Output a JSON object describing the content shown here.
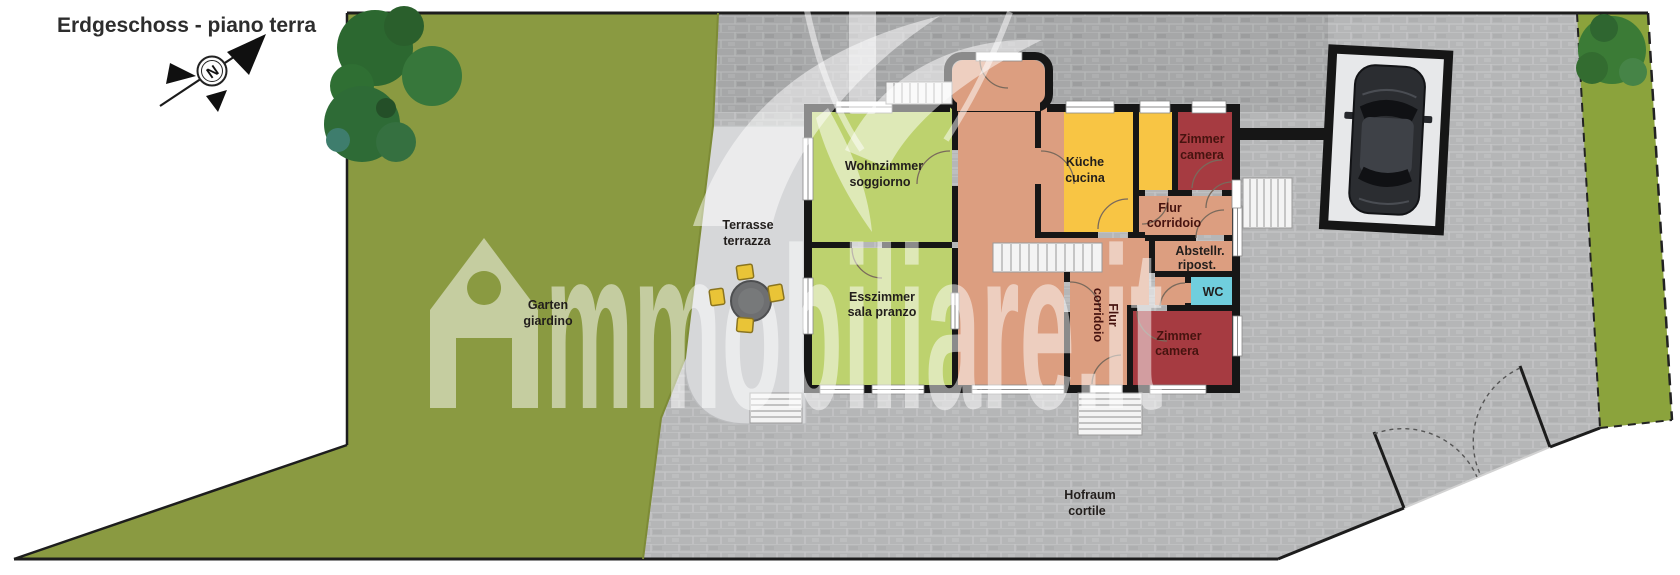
{
  "title": "Erdgeschoss - piano terra",
  "compass": {
    "north_label": "N"
  },
  "watermark": {
    "brand": "mmobiliare.it"
  },
  "labels": {
    "wohnzimmer": {
      "line1": "Wohnzimmer",
      "line2": "soggiorno"
    },
    "esszimmer": {
      "line1": "Esszimmer",
      "line2": "sala pranzo"
    },
    "kueche": {
      "line1": "Küche",
      "line2": "cucina"
    },
    "zimmer_top": {
      "line1": "Zimmer",
      "line2": "camera"
    },
    "zimmer_bottom": {
      "line1": "Zimmer",
      "line2": "camera"
    },
    "flur_top": {
      "line1": "Flur",
      "line2": "corridoio"
    },
    "flur_mid": {
      "line1": "Flur",
      "line2": "corridoio"
    },
    "abstellraum": {
      "line1": "Abstellr.",
      "line2": "ripost."
    },
    "wc": {
      "line1": "WC"
    },
    "terrasse": {
      "line1": "Terrasse",
      "line2": "terrazza"
    },
    "garten": {
      "line1": "Garten",
      "line2": "giardino"
    },
    "hofraum": {
      "line1": "Hofraum",
      "line2": "cortile"
    }
  },
  "colors": {
    "grass": "#8a9a41",
    "grass_right": "#8ba33c",
    "tree_green": "#2e6b2f",
    "paving": "#b5b6b7",
    "paving_dark": "#a6a7a8",
    "terrace_gray": "#d6d7d9",
    "wall_black": "#161616",
    "living_green": "#bdd26e",
    "kitchen_yellow": "#f8c544",
    "hall_salmon": "#dc9e80",
    "bedroom_red": "#a63b41",
    "wc_cyan": "#70cedd",
    "stairs_white": "#f4f4f4",
    "car_dark": "#2b2d31",
    "chair_yellow": "#e9c437",
    "watermark_white": "#ffffff"
  }
}
